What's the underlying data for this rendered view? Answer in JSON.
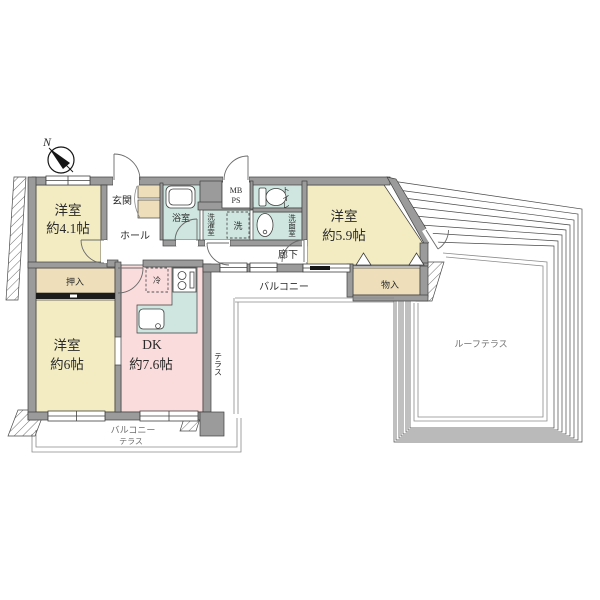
{
  "compass": {
    "north_label": "N"
  },
  "rooms": {
    "bedroom_41": {
      "line1": "洋室",
      "line2": "約4.1帖"
    },
    "genkan": "玄関",
    "hall": "ホール",
    "bath": "浴室",
    "mb_ps": {
      "line1": "MB",
      "line2": "PS"
    },
    "laundry": "洗濯室",
    "washer": "洗",
    "toilet": "トイレ",
    "washroom": "洗面室",
    "corridor": "廊下",
    "bedroom_59": {
      "line1": "洋室",
      "line2": "約5.9帖"
    },
    "storage": "物入",
    "balcony_mid": "バルコニー",
    "oshiire": "押入",
    "bedroom_6": {
      "line1": "洋室",
      "line2": "約6帖"
    },
    "dk": {
      "line1": "DK",
      "line2": "約7.6帖"
    },
    "fridge": "冷",
    "terrace_side": "テラス",
    "roof_terrace": "ルーフテラス",
    "balcony_bottom": {
      "line1": "バルコニー",
      "line2": "テラス"
    }
  },
  "colors": {
    "room_yellow": "#f3ecc3",
    "room_pink": "#f9dcdb",
    "room_teal": "#cfe6e0",
    "room_tan": "#eedfba",
    "wall_gray": "#9b9b9b",
    "line_dark": "#3f3f3f"
  }
}
